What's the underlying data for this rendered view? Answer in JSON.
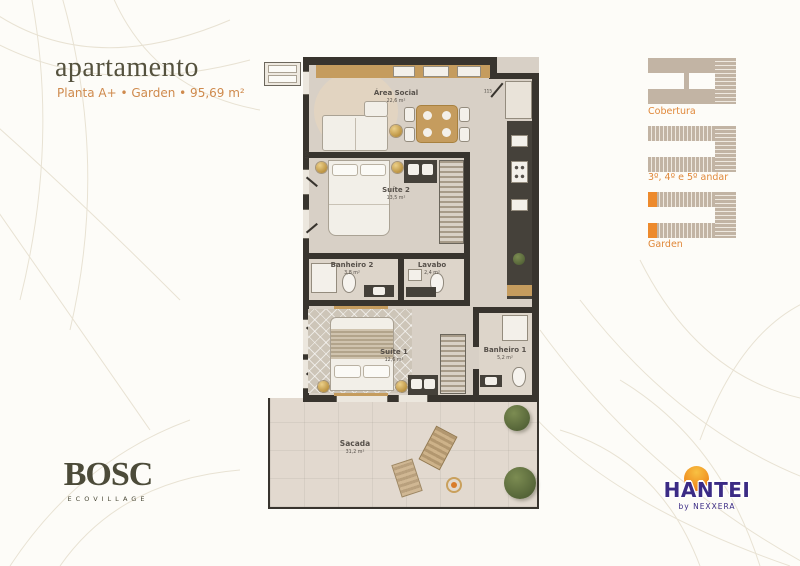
{
  "header": {
    "title": "apartamento",
    "subtitle": "Planta A+  •  Garden  •  95,69 m²"
  },
  "plan": {
    "rooms": [
      {
        "name": "Área Social",
        "area": "22,6 m²"
      },
      {
        "name": "Suíte 2",
        "area": "13,5 m²"
      },
      {
        "name": "Banheiro 2",
        "area": "3,8 m²"
      },
      {
        "name": "Lavabo",
        "area": "2,4 m²"
      },
      {
        "name": "Suíte 1",
        "area": "12,6 m²"
      },
      {
        "name": "Banheiro 1",
        "area": "5,2 m²"
      },
      {
        "name": "Sacada",
        "area": "31,2 m²"
      }
    ],
    "dimensions": [
      "115",
      "410"
    ]
  },
  "keyplans": [
    {
      "label": "Cobertura",
      "highlight": false
    },
    {
      "label": "3º, 4º e 5º andar",
      "highlight": false
    },
    {
      "label": "Garden",
      "highlight": true
    }
  ],
  "logos": {
    "bosc": {
      "name": "BOSC",
      "tagline": "ECOVILLAGE"
    },
    "hantei": {
      "name": "HANTEI",
      "by": "by NEXXERA"
    }
  },
  "colors": {
    "accent_orange": "#e0883a",
    "subtitle_orange": "#cf8a4d",
    "wall": "#38342e",
    "highlight_unit": "#ed8a2d",
    "hantei_purple": "#3b2b85",
    "bosc_olive": "#4c4b39"
  }
}
